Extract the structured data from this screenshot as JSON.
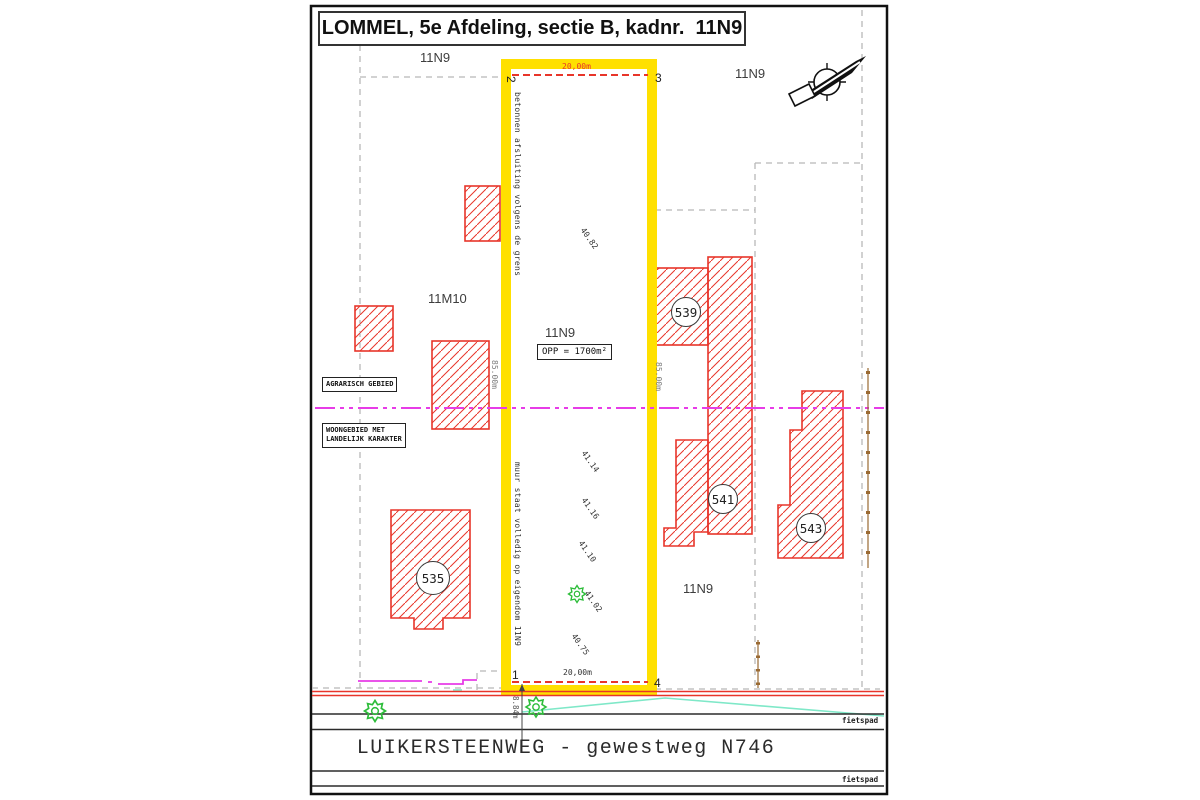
{
  "title": "LOMMEL, 5e Afdeling, sectie B, kadnr.  11N9",
  "parcel_labels": {
    "top_left": "11N9",
    "top_right": "11N9",
    "bottom_right": "11N9",
    "neighbor_left": "11M10"
  },
  "main_parcel": {
    "label": "11N9",
    "area": "OPP = 1700m²",
    "width_top": "20,00m",
    "width_bottom": "20,00m",
    "depth_left": "85.00m",
    "depth_right": "85.00m",
    "corner_1": "1",
    "corner_2": "2",
    "corner_3": "3",
    "corner_4": "4",
    "note_fence": "betonnen afsluiting volgens de grens",
    "note_wall": "muur staat volledig op eigendom 11N9",
    "offset_road": "8.84m"
  },
  "elevations": {
    "e1": "40.82",
    "e2": "41.14",
    "e3": "41.16",
    "e4": "41.10",
    "e5": "41.02",
    "e6": "40.75"
  },
  "zones": {
    "agrarisch": "AGRARISCH GEBIED",
    "woongebied_line1": "WOONGEBIED MET",
    "woongebied_line2": "LANDELIJK KARAKTER"
  },
  "houses": {
    "h535": "535",
    "h539": "539",
    "h541": "541",
    "h543": "543"
  },
  "road": {
    "name": "LUIKERSTEENWEG - gewestweg N746",
    "bike_path_top": "fietspad",
    "bike_path_bottom": "fietspad"
  },
  "colors": {
    "highlight_yellow": "#ffe000",
    "plan_red": "#e8352a",
    "boundary_gray": "#b8b8b8",
    "zone_magenta": "#e73ce7",
    "utility_cyan": "#7fe8c8",
    "vegetation_green": "#2dbd3a",
    "fence_brown": "#9a6a33"
  }
}
